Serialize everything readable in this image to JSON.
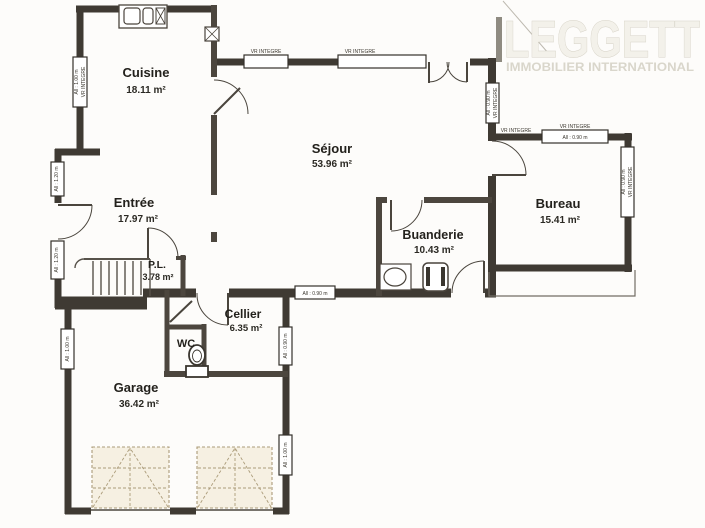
{
  "logo": {
    "brand": "LEGGETT",
    "tagline": "IMMOBILIER INTERNATIONAL"
  },
  "rooms": [
    {
      "name": "Cuisine",
      "area": "18.11 m²"
    },
    {
      "name": "Séjour",
      "area": "53.96 m²"
    },
    {
      "name": "Entrée",
      "area": "17.97 m²"
    },
    {
      "name": "P.L.",
      "area": "3.78 m²"
    },
    {
      "name": "Cellier",
      "area": "6.35 m²"
    },
    {
      "name": "WC",
      "area": ""
    },
    {
      "name": "Garage",
      "area": "36.42 m²"
    },
    {
      "name": "Buanderie",
      "area": "10.43 m²"
    },
    {
      "name": "Bureau",
      "area": "15.41 m²"
    }
  ],
  "ann": {
    "vr": "VR INTEGRE",
    "a090": "All : 0.90 m",
    "a100": "All : 1.00 m",
    "a120": "All : 1.20 m"
  },
  "colors": {
    "wall_exterior": "#3f3a33",
    "wall_interior": "#4c463e",
    "paper": "#fdfcfa",
    "label": "#23211c",
    "logo_fill": "#f3f1ea",
    "logo_stroke": "#d5d1c5",
    "tagline": "#d9d6cb",
    "garage_door_fill": "#f6f0e2",
    "garage_door_line": "#b3a384"
  }
}
